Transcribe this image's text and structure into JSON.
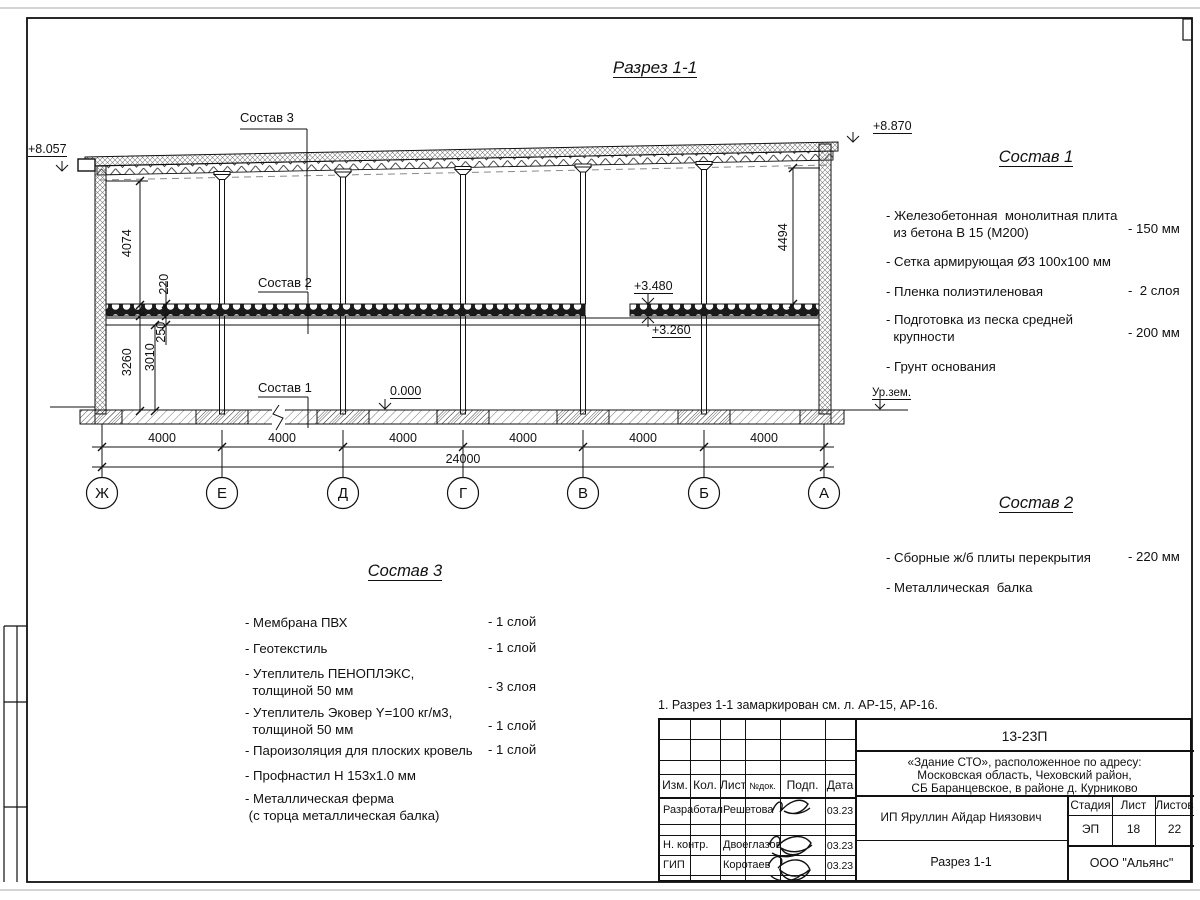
{
  "title": "Разрез 1-1",
  "drawing": {
    "elevations": {
      "top_left": "+8.057",
      "top_right": "+8.870",
      "slab_top": "+3.480",
      "slab_bottom": "+3.260",
      "floor": "0.000",
      "ground": "Ур.зем."
    },
    "leaders": {
      "comp3": "Состав 3",
      "comp2": "Состав 2",
      "comp1": "Состав 1"
    },
    "vdims": {
      "d4074": "4074",
      "d220": "220",
      "d250": "250",
      "d3260": "3260",
      "d3010": "3010",
      "d4494": "4494"
    },
    "dims": {
      "bay": "4000",
      "total": "24000"
    },
    "grid": {
      "labels": [
        "Ж",
        "Е",
        "Д",
        "Г",
        "В",
        "Б",
        "А"
      ]
    }
  },
  "comp1": {
    "title": "Состав 1",
    "items": [
      {
        "text": "- Железобетонная  монолитная плита\n  из бетона В 15 (М200)",
        "value": "- 150 мм"
      },
      {
        "text": "- Сетка армирующая Ø3 100х100 мм",
        "value": ""
      },
      {
        "text": "- Пленка полиэтиленовая",
        "value": "-  2 слоя"
      },
      {
        "text": "- Подготовка из песка средней\n  крупности",
        "value": "- 200 мм"
      },
      {
        "text": "- Грунт основания",
        "value": ""
      }
    ]
  },
  "comp2": {
    "title": "Состав 2",
    "items": [
      {
        "text": "- Сборные ж/б плиты перекрытия",
        "value": "- 220 мм"
      },
      {
        "text": "- Металлическая  балка",
        "value": ""
      }
    ]
  },
  "comp3": {
    "title": "Состав 3",
    "items": [
      {
        "text": "- Мембрана ПВХ",
        "value": "- 1 слой"
      },
      {
        "text": "- Геотекстиль",
        "value": "- 1 слой"
      },
      {
        "text": "- Утеплитель ПЕНОПЛЭКС,\n  толщиной 50 мм",
        "value": "- 3 слоя"
      },
      {
        "text": "- Утеплитель Эковер Y=100 кг/м3,\n  толщиной 50 мм",
        "value": "- 1 слой"
      },
      {
        "text": "- Пароизоляция для плоских кровель",
        "value": "- 1 слой"
      },
      {
        "text": "- Профнастил Н 153х1.0 мм",
        "value": ""
      },
      {
        "text": "- Металлическая ферма\n (с торца металлическая балка)",
        "value": ""
      }
    ]
  },
  "note": "1. Разрез 1-1 замаркирован см. л. АР-15, АР-16.",
  "stamp": {
    "header_cols": [
      "Изм.",
      "Кол.",
      "Лист",
      "№док.",
      "Подп.",
      "Дата"
    ],
    "rows": [
      {
        "role": "Разработал",
        "name": "Решетова",
        "date": "03.23"
      },
      {
        "role": "Н. контр.",
        "name": "Двоеглазов",
        "date": "03.23"
      },
      {
        "role": "ГИП",
        "name": "Коротаев",
        "date": "03.23"
      }
    ],
    "doc_number": "13-23П",
    "project_lines": [
      "«Здание СТО», расположенное по адресу:",
      "Московская область, Чеховский район,",
      "СБ Баранцевское, в районе д. Курниково"
    ],
    "client": "ИП Яруллин Айдар Ниязович",
    "sheet_title": "Разрез 1-1",
    "stage_label": "Стадия",
    "sheet_label": "Лист",
    "sheets_label": "Листов",
    "stage": "ЭП",
    "sheet": "18",
    "sheets": "22",
    "company": "ООО \"Альянс\""
  }
}
